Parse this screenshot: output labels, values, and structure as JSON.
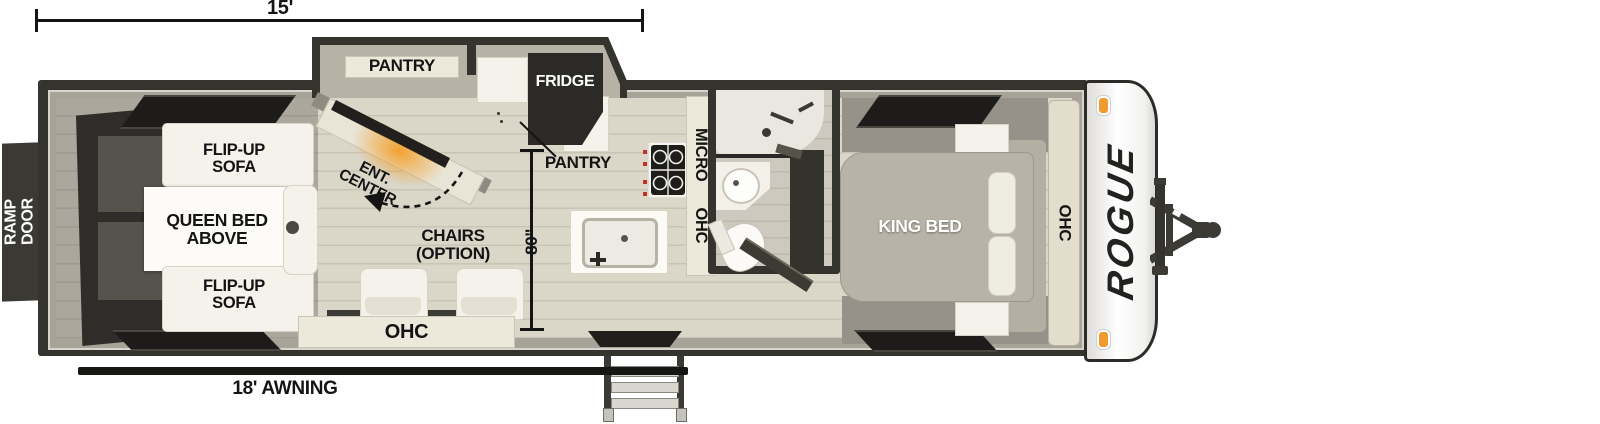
{
  "dims": {
    "length_ft": "15'",
    "width_in": "80\"",
    "awning": "18' AWNING"
  },
  "exterior": {
    "brand": "ROGUE",
    "ramp_door": "RAMP DOOR"
  },
  "garage": {
    "sofa_top": "FLIP-UP SOFA",
    "queen_bed": "QUEEN BED ABOVE",
    "sofa_bottom": "FLIP-UP SOFA"
  },
  "living": {
    "ent_center": "ENT. CENTER",
    "chairs": "CHAIRS (OPTION)",
    "ohc": "OHC"
  },
  "kitchen": {
    "pantry_slide": "PANTRY",
    "fridge": "FRIDGE",
    "pantry": "PANTRY",
    "micro": "MICRO",
    "ohc": "OHC"
  },
  "bedroom": {
    "king_bed": "KING BED",
    "ohc": "OHC"
  },
  "colors": {
    "wall": "#35332e",
    "floor": "#d9d5c7",
    "slide_floor": "#b6b2a6",
    "cabinet_cream": "#ece8da",
    "window": "#1d1c1a",
    "accent_orange": "#f09a30"
  }
}
